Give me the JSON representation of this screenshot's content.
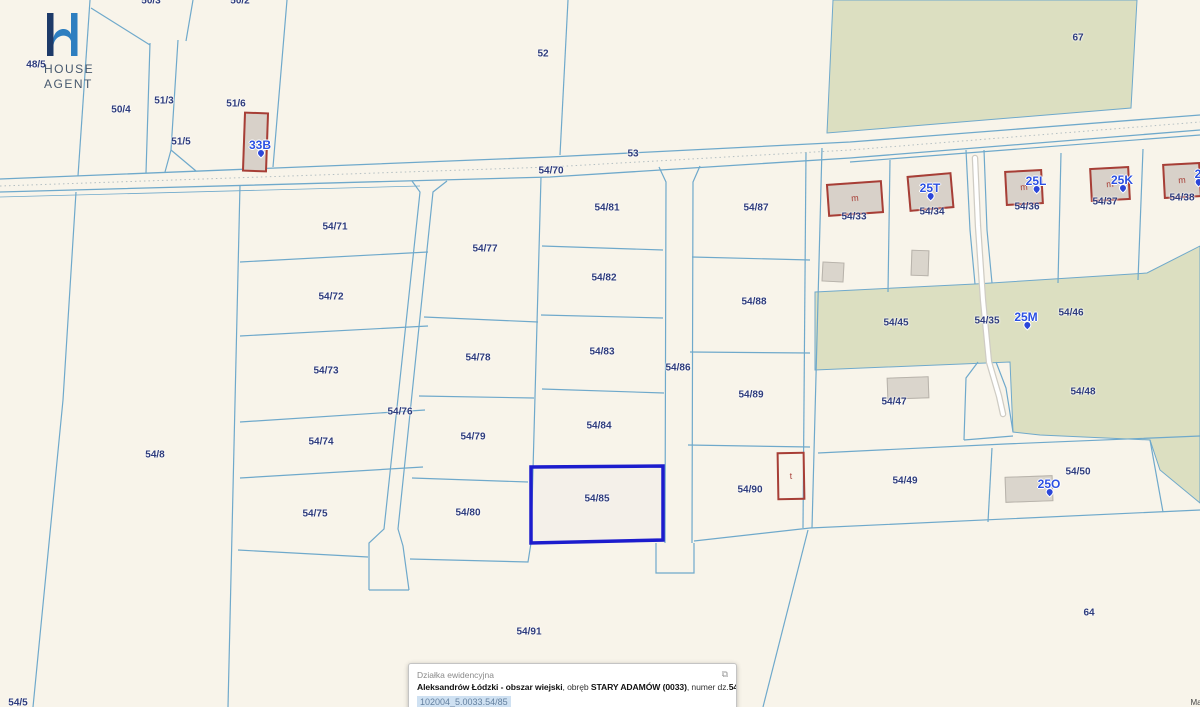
{
  "colors": {
    "background": "#f8f4ea",
    "parcel_line": "#6fa9cb",
    "vegetation_green": "#dcdfc1",
    "parcel_label": "#2e3c7d",
    "address_label": "#2b50e2",
    "building_outline": "#a73e36",
    "building_fill": "#d8d1c9",
    "highlight_outline": "#1c1ccd",
    "popup_chip_bg": "#cfe1f2"
  },
  "brand": {
    "line1": "HOUSE",
    "line2": "AGENT"
  },
  "popup": {
    "title": "Działka ewidencyjna",
    "region_bold": "Aleksandrów Łódzki - obszar wiejski",
    "obreb_prefix": ", obręb ",
    "obreb_bold": "STARY ADAMÓW (0033)",
    "number_prefix": ", numer dz.",
    "number_bold": "54/85",
    "id": "102004_5.0033.54/85",
    "link": "Pełna informacja o działce",
    "expand_icon": "⧉"
  },
  "attribution": "Map",
  "map": {
    "selected_parcel": "54/85",
    "parcel_labels": [
      {
        "text": "48/5",
        "x": 36,
        "y": 65
      },
      {
        "text": "50/3",
        "x": 151,
        "y": 1
      },
      {
        "text": "50/2",
        "x": 240,
        "y": 1
      },
      {
        "text": "50/4",
        "x": 121,
        "y": 110
      },
      {
        "text": "51/3",
        "x": 164,
        "y": 101
      },
      {
        "text": "51/5",
        "x": 181,
        "y": 142
      },
      {
        "text": "51/6",
        "x": 236,
        "y": 104
      },
      {
        "text": "52",
        "x": 543,
        "y": 54
      },
      {
        "text": "53",
        "x": 633,
        "y": 154
      },
      {
        "text": "54/70",
        "x": 551,
        "y": 171
      },
      {
        "text": "67",
        "x": 1078,
        "y": 38
      },
      {
        "text": "54/8",
        "x": 155,
        "y": 455
      },
      {
        "text": "54/71",
        "x": 335,
        "y": 227
      },
      {
        "text": "54/72",
        "x": 331,
        "y": 297
      },
      {
        "text": "54/73",
        "x": 326,
        "y": 371
      },
      {
        "text": "54/74",
        "x": 321,
        "y": 442
      },
      {
        "text": "54/75",
        "x": 315,
        "y": 514
      },
      {
        "text": "54/76",
        "x": 400,
        "y": 412
      },
      {
        "text": "54/77",
        "x": 485,
        "y": 249
      },
      {
        "text": "54/78",
        "x": 478,
        "y": 358
      },
      {
        "text": "54/79",
        "x": 473,
        "y": 437
      },
      {
        "text": "54/80",
        "x": 468,
        "y": 513
      },
      {
        "text": "54/81",
        "x": 607,
        "y": 208
      },
      {
        "text": "54/82",
        "x": 604,
        "y": 278
      },
      {
        "text": "54/83",
        "x": 602,
        "y": 352
      },
      {
        "text": "54/84",
        "x": 599,
        "y": 426
      },
      {
        "text": "54/85",
        "x": 597,
        "y": 499
      },
      {
        "text": "54/86",
        "x": 678,
        "y": 368
      },
      {
        "text": "54/87",
        "x": 756,
        "y": 208
      },
      {
        "text": "54/88",
        "x": 754,
        "y": 302
      },
      {
        "text": "54/89",
        "x": 751,
        "y": 395
      },
      {
        "text": "54/90",
        "x": 750,
        "y": 490
      },
      {
        "text": "54/91",
        "x": 529,
        "y": 632
      },
      {
        "text": "54/33",
        "x": 854,
        "y": 217
      },
      {
        "text": "54/34",
        "x": 932,
        "y": 212
      },
      {
        "text": "54/36",
        "x": 1027,
        "y": 207
      },
      {
        "text": "54/37",
        "x": 1105,
        "y": 202
      },
      {
        "text": "54/38",
        "x": 1182,
        "y": 198
      },
      {
        "text": "54/45",
        "x": 896,
        "y": 323
      },
      {
        "text": "54/35",
        "x": 987,
        "y": 321
      },
      {
        "text": "54/46",
        "x": 1071,
        "y": 313
      },
      {
        "text": "54/47",
        "x": 894,
        "y": 402
      },
      {
        "text": "54/48",
        "x": 1083,
        "y": 392
      },
      {
        "text": "54/49",
        "x": 905,
        "y": 481
      },
      {
        "text": "54/50",
        "x": 1078,
        "y": 472
      },
      {
        "text": "64",
        "x": 1089,
        "y": 613
      },
      {
        "text": "54/5",
        "x": 18,
        "y": 703
      }
    ],
    "address_labels": [
      {
        "text": "33B",
        "x": 260,
        "y": 145
      },
      {
        "text": "25T",
        "x": 930,
        "y": 188
      },
      {
        "text": "25L",
        "x": 1036,
        "y": 181
      },
      {
        "text": "25K",
        "x": 1122,
        "y": 180
      },
      {
        "text": "25M",
        "x": 1026,
        "y": 317
      },
      {
        "text": "25O",
        "x": 1049,
        "y": 484
      },
      {
        "text": "2",
        "x": 1198,
        "y": 174
      }
    ],
    "buildings": [
      {
        "type": "red",
        "letter": "m",
        "x": 827,
        "y": 182,
        "w": 56,
        "h": 33,
        "rot": -4
      },
      {
        "type": "red",
        "letter": "",
        "x": 908,
        "y": 174,
        "w": 45,
        "h": 36,
        "rot": -5
      },
      {
        "type": "red",
        "letter": "m",
        "x": 1005,
        "y": 170,
        "w": 38,
        "h": 35,
        "rot": -3
      },
      {
        "type": "red",
        "letter": "m",
        "x": 1090,
        "y": 167,
        "w": 40,
        "h": 34,
        "rot": -3
      },
      {
        "type": "red",
        "letter": "m",
        "x": 1163,
        "y": 163,
        "w": 38,
        "h": 35,
        "rot": -3
      },
      {
        "type": "red",
        "letter": "",
        "x": 243,
        "y": 112,
        "w": 25,
        "h": 60,
        "rot": 2
      },
      {
        "type": "gray",
        "letter": "",
        "x": 822,
        "y": 262,
        "w": 22,
        "h": 20,
        "rot": 3
      },
      {
        "type": "gray",
        "letter": "",
        "x": 911,
        "y": 250,
        "w": 18,
        "h": 26,
        "rot": 2
      },
      {
        "type": "gray",
        "letter": "",
        "x": 887,
        "y": 377,
        "w": 42,
        "h": 22,
        "rot": -2
      },
      {
        "type": "gray",
        "letter": "",
        "x": 1005,
        "y": 476,
        "w": 48,
        "h": 26,
        "rot": -2
      },
      {
        "type": "open",
        "letter": "t",
        "x": 777,
        "y": 452,
        "w": 28,
        "h": 48,
        "rot": -1
      }
    ]
  }
}
